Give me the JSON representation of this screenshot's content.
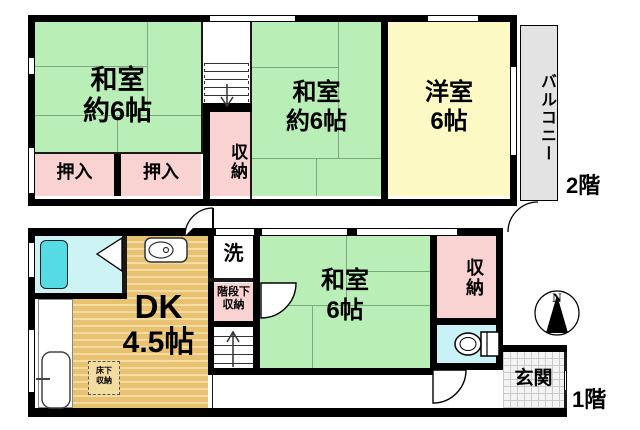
{
  "floor2": {
    "label": "2階",
    "washitsu_left": {
      "name": "和室",
      "size": "約6帖"
    },
    "washitsu_mid": {
      "name": "和室",
      "size": "約6帖"
    },
    "youshitsu": {
      "name": "洋室",
      "size": "6帖"
    },
    "balcony_label": "バルコニー",
    "oshiire_1": "押入",
    "oshiire_2": "押入",
    "storage_label": "収納"
  },
  "floor1": {
    "label": "1階",
    "dk": {
      "name": "DK",
      "size": "4.5帖"
    },
    "washitsu": {
      "name": "和室",
      "size": "6帖"
    },
    "storage_label": "収納",
    "laundry_label": "洗",
    "under_stairs": {
      "line1": "階段下",
      "line2": "収納"
    },
    "underfloor": {
      "line1": "床下",
      "line2": "収納"
    },
    "entrance_label": "玄関"
  },
  "compass": {
    "north_label": "N"
  },
  "colors": {
    "wall": "#000000",
    "tatami_green": "#b9efb6",
    "closet_pink": "#f9d2d2",
    "western_yellow": "#fdf9c5",
    "dk_floor_tan": "#e8c272",
    "dk_floor_stripe": "#f3dc9f",
    "bathroom_cyan": "#cdf3f5",
    "bathtub_cyan": "#55dbe4",
    "toilet_cyan": "#c9f2f6",
    "balcony_gray": "#e3e3e3",
    "entrance_gray": "#f4f4f4"
  }
}
